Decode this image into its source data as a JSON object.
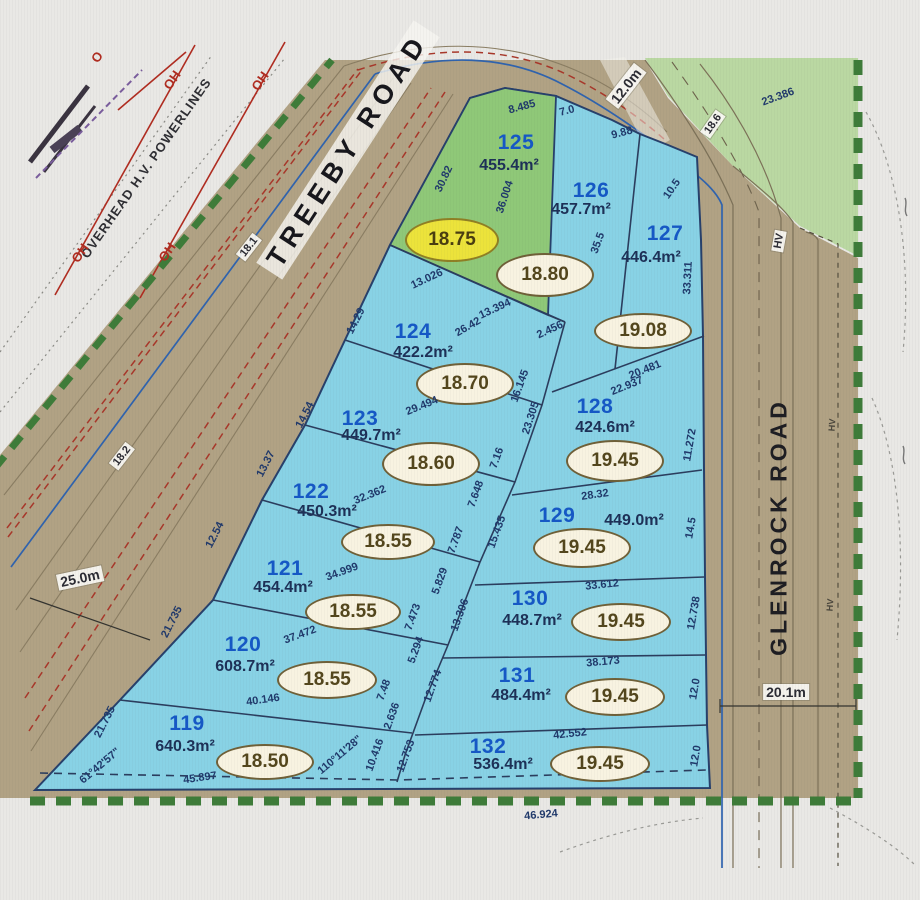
{
  "title": "Subdivision survey plan - lots 119-132",
  "roads": {
    "treeby": {
      "name": "TREEBY  ROAD",
      "width": "25.0m"
    },
    "glenrock": {
      "name": "GLENROCK  ROAD",
      "width": "20.1m"
    },
    "entry_width": "12.0m",
    "powerline_label": "OVERHEAD H.V. POWERLINES"
  },
  "annotations": {
    "oh_marker": "OH",
    "o_marker": "O",
    "hv_marker": "HV",
    "spot_levels": [
      "18.1",
      "18.2",
      "18.6"
    ]
  },
  "lots": [
    {
      "number": "119",
      "area": "640.3m²",
      "level": "18.50"
    },
    {
      "number": "120",
      "area": "608.7m²",
      "level": "18.55"
    },
    {
      "number": "121",
      "area": "454.4m²",
      "level": "18.55"
    },
    {
      "number": "122",
      "area": "450.3m²",
      "level": "18.55"
    },
    {
      "number": "123",
      "area": "449.7m²",
      "level": "18.60"
    },
    {
      "number": "124",
      "area": "422.2m²",
      "level": "18.70"
    },
    {
      "number": "125",
      "area": "455.4m²",
      "level": "18.75",
      "highlight": true
    },
    {
      "number": "126",
      "area": "457.7m²",
      "level": "18.80"
    },
    {
      "number": "127",
      "area": "446.4m²",
      "level": "19.08"
    },
    {
      "number": "128",
      "area": "424.6m²",
      "level": "19.45"
    },
    {
      "number": "129",
      "area": "449.0m²",
      "level": "19.45"
    },
    {
      "number": "130",
      "area": "448.7m²",
      "level": "19.45"
    },
    {
      "number": "131",
      "area": "484.4m²",
      "level": "19.45"
    },
    {
      "number": "132",
      "area": "536.4m²",
      "level": "19.45"
    }
  ],
  "dimensions": [
    "8.485",
    "7.0",
    "30.82",
    "36.004",
    "13.026",
    "9.88",
    "10.5",
    "35.5",
    "13.394",
    "2.456",
    "26.42",
    "14.29",
    "16.145",
    "23.305",
    "20.481",
    "22.937",
    "33.311",
    "11.272",
    "29.494",
    "14.54",
    "7.16",
    "7.648",
    "15.435",
    "28.32",
    "14.5",
    "32.362",
    "13.37",
    "7.787",
    "5.829",
    "34.999",
    "12.54",
    "33.612",
    "13.306",
    "12.738",
    "37.472",
    "21.735",
    "7.473",
    "5.294",
    "38.173",
    "12.774",
    "12.0",
    "40.146",
    "7.48",
    "2.636",
    "21.735",
    "42.552",
    "12.753",
    "10.416",
    "12.0",
    "45.897",
    "46.924",
    "23.386",
    "61°42'57\"",
    "110°11'28\""
  ],
  "colors": {
    "lot_fill": "#88d2e5",
    "lot125_fill": "#8fc878",
    "road_fill": "#b1a284",
    "reserve_green": "#bad8a2",
    "boundary_green": "#3e7c39",
    "lot_number": "#1558c6",
    "level_oval_fill": "#f8f3e1",
    "highlight_oval_fill": "#ece33b",
    "powerline_red": "#b02c20",
    "water_blue": "#2f63ae"
  }
}
